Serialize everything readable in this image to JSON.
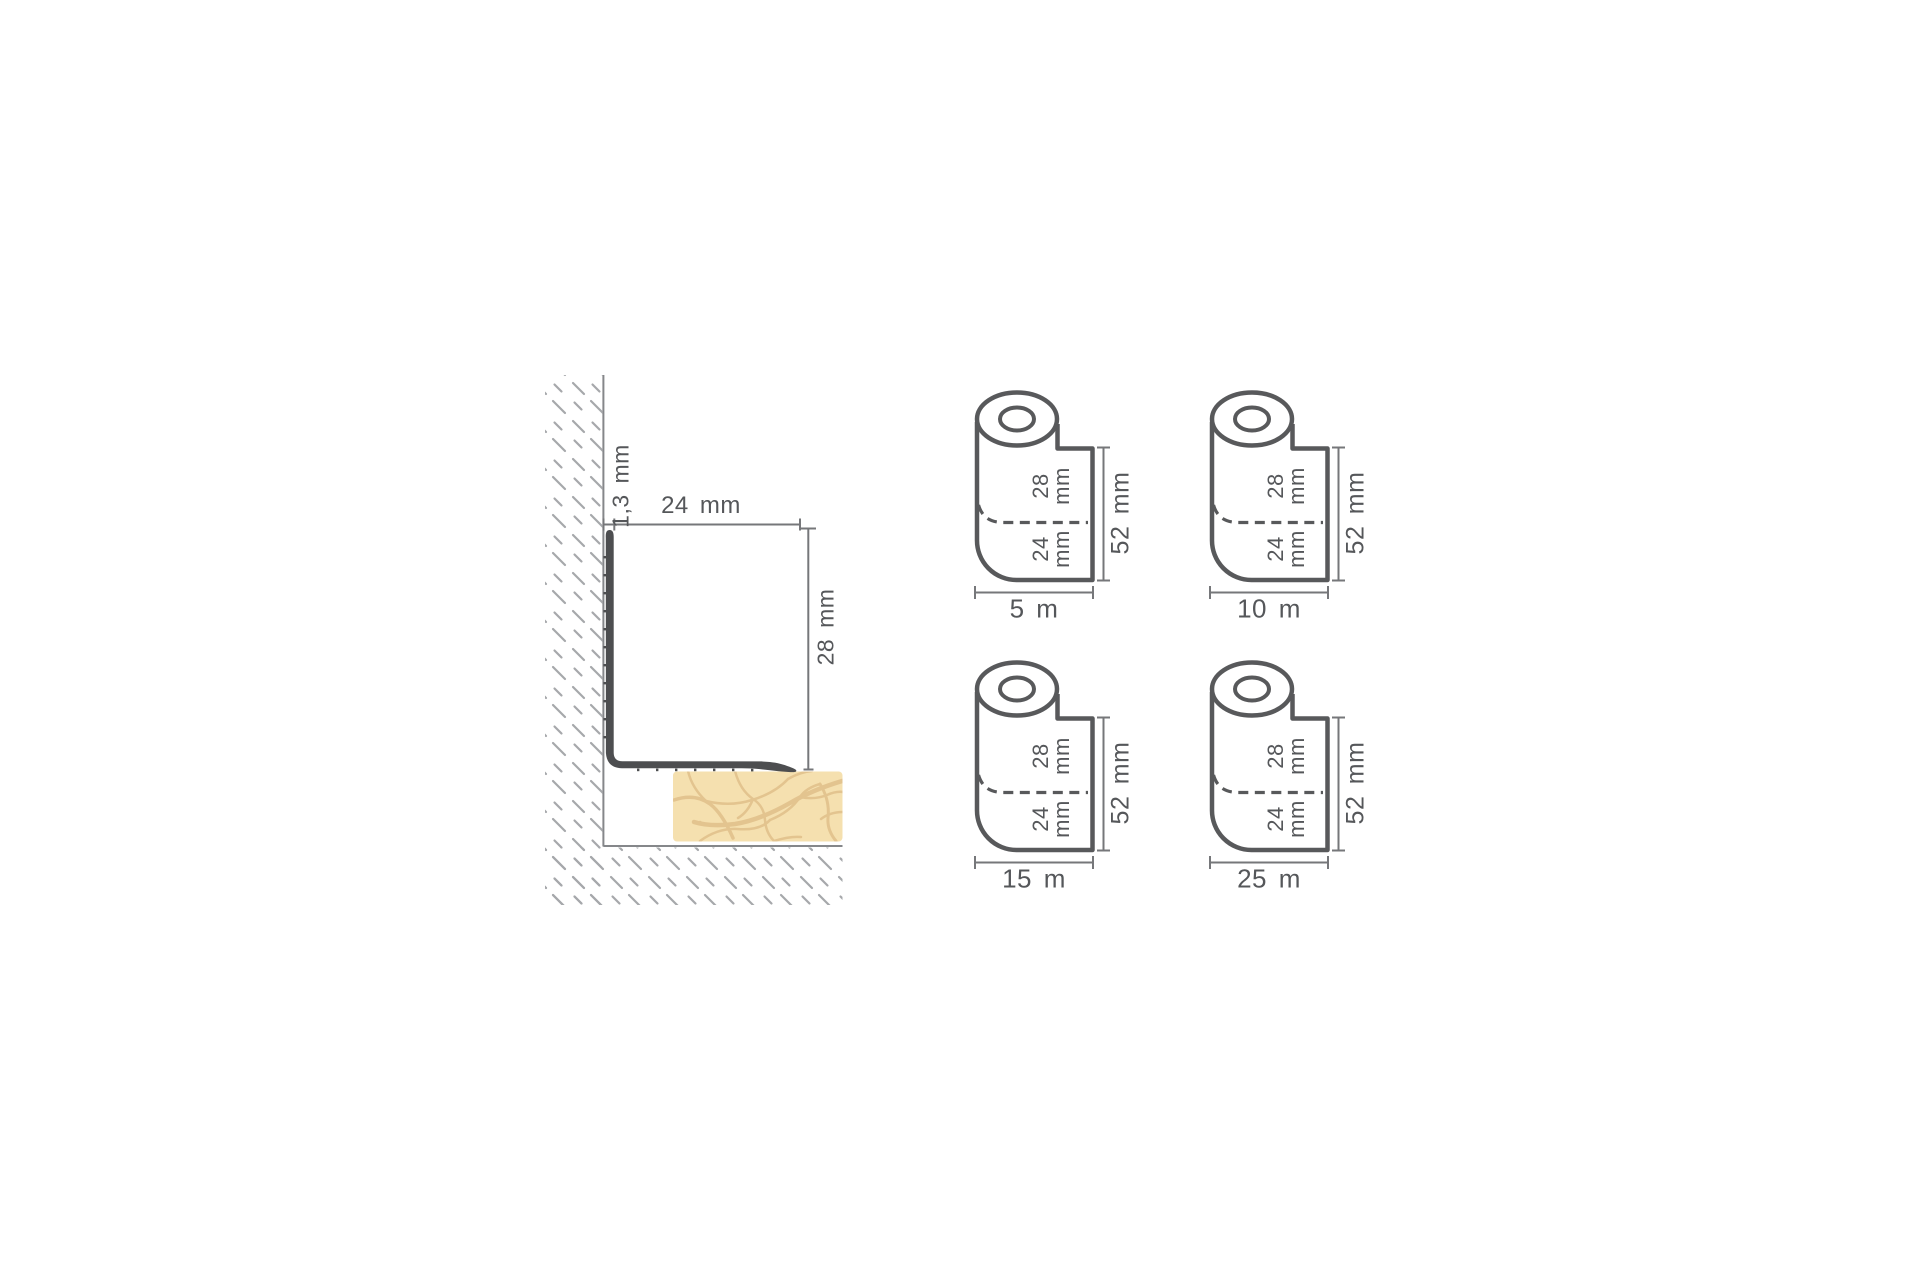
{
  "profile_diagram": {
    "thickness": "1,3 mm",
    "width": "24 mm",
    "height": "28 mm"
  },
  "roll_dimensions": {
    "upper_width_line1": "28",
    "upper_width_line2": "mm",
    "lower_width_line1": "24",
    "lower_width_line2": "mm",
    "total_width": "52 mm"
  },
  "rolls": [
    {
      "length": "5 m"
    },
    {
      "length": "10 m"
    },
    {
      "length": "15 m"
    },
    {
      "length": "25 m"
    }
  ],
  "colors": {
    "outline_gray": "#58595b",
    "thin_line_gray": "#85878a",
    "dimension_gray": "#76777a",
    "hatch_gray": "#a6a8ab",
    "profile_dark": "#4d4e50",
    "tile_fill": "#f5e0af",
    "tile_crack": "#e3c48f",
    "text_gray": "#55575a",
    "background": "#ffffff"
  }
}
